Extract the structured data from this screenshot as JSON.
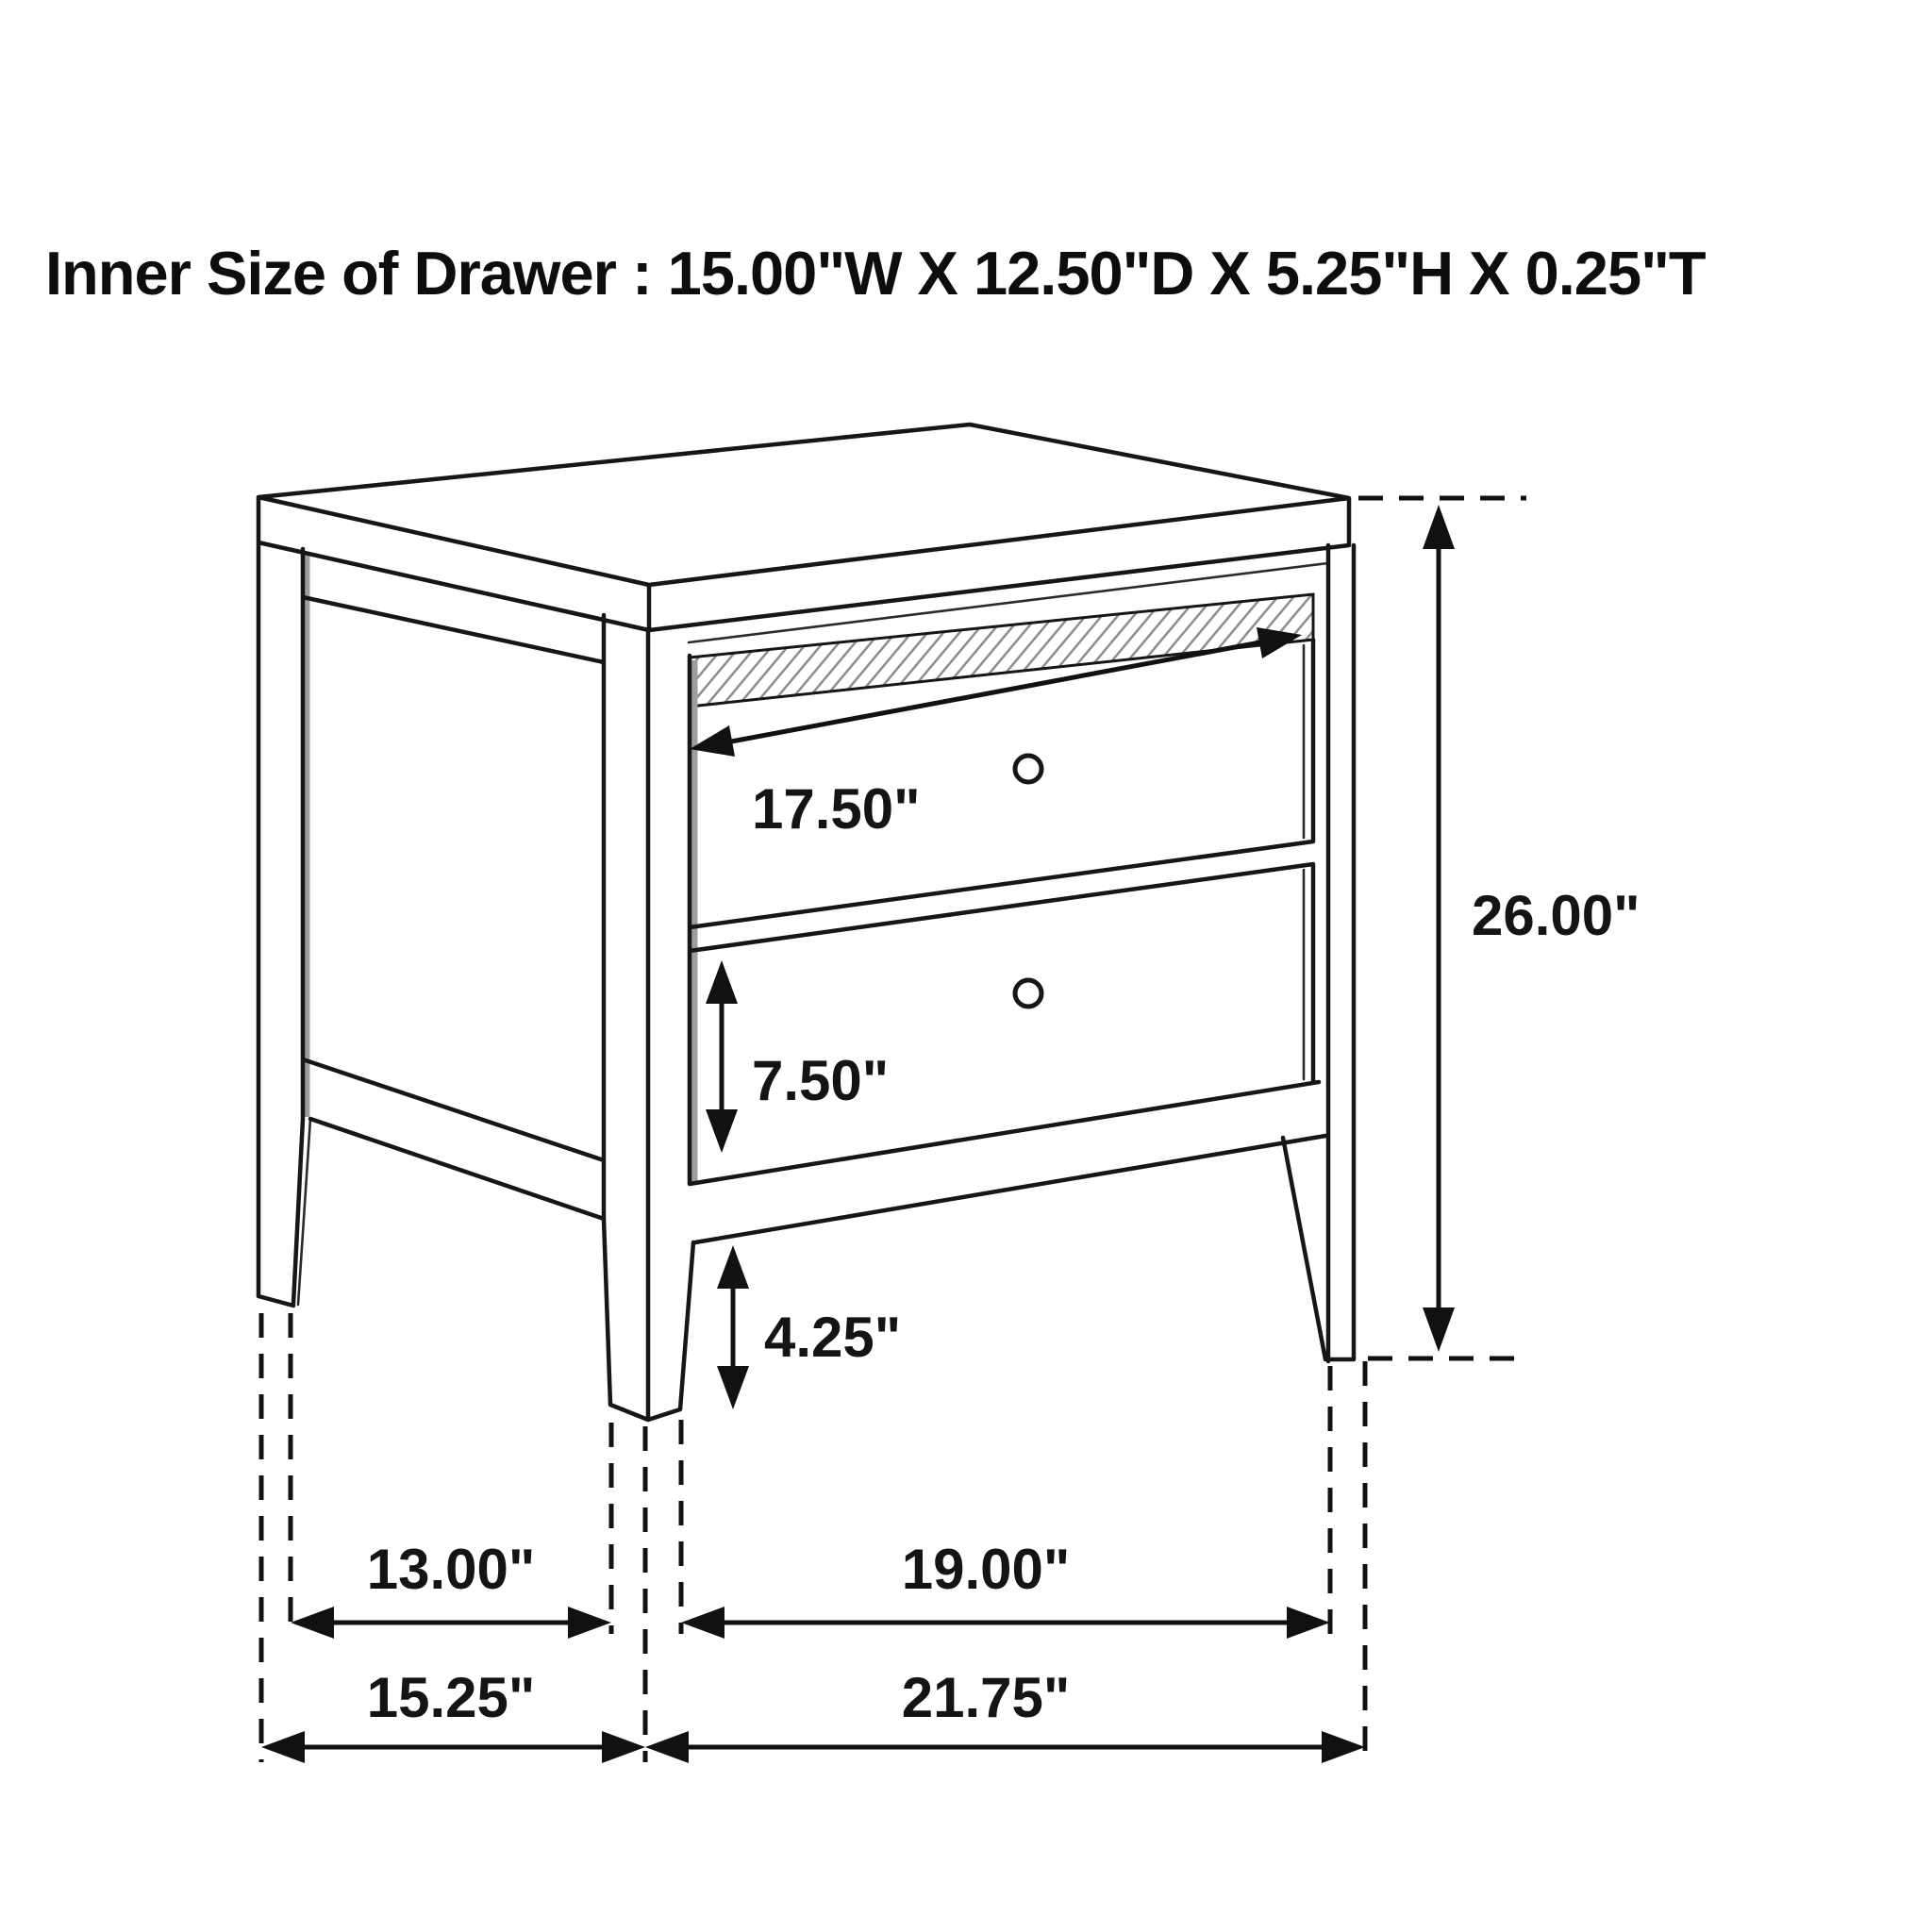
{
  "title": "Inner Size of Drawer : 15.00\"W X 12.50\"D X 5.25\"H X 0.25\"T",
  "figure": {
    "subject": "two-drawer nightstand isometric line drawing with dimension callouts",
    "dims": {
      "drawer_front_width": "17.50\"",
      "overall_height": "26.00\"",
      "lower_drawer_height": "7.50\"",
      "leg_height": "4.25\"",
      "side_leg_clearance": "13.00\"",
      "front_leg_clearance": "19.00\"",
      "overall_depth": "15.25\"",
      "overall_width": "21.75\""
    }
  }
}
